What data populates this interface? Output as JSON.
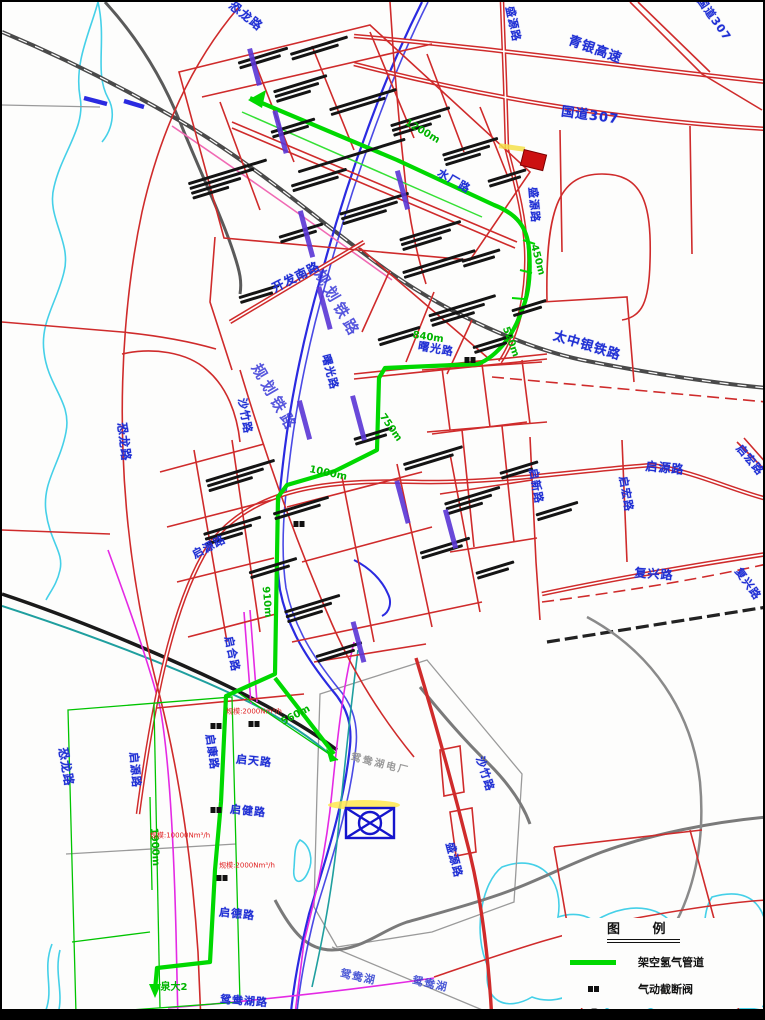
{
  "map": {
    "labels": [
      {
        "text": "恐龙路",
        "x": 244,
        "y": 14,
        "rot": 38,
        "kind": "road",
        "size": 12
      },
      {
        "text": "国道307",
        "x": 712,
        "y": 17,
        "rot": 55,
        "kind": "road",
        "size": 11
      },
      {
        "text": "青银高速",
        "x": 593,
        "y": 48,
        "rot": 20,
        "kind": "road",
        "size": 13
      },
      {
        "text": "国道307",
        "x": 588,
        "y": 114,
        "rot": 8,
        "kind": "road",
        "size": 13
      },
      {
        "text": "盛源路",
        "x": 511,
        "y": 22,
        "rot": 78,
        "kind": "road",
        "size": 11
      },
      {
        "text": "盛源路",
        "x": 532,
        "y": 203,
        "rot": 85,
        "kind": "road",
        "size": 11
      },
      {
        "text": "水厂路",
        "x": 452,
        "y": 179,
        "rot": 30,
        "kind": "road",
        "size": 11
      },
      {
        "text": "太中银铁路",
        "x": 585,
        "y": 344,
        "rot": 17,
        "kind": "road",
        "size": 13
      },
      {
        "text": "恐龙路",
        "x": 122,
        "y": 440,
        "rot": 83,
        "kind": "road",
        "size": 12
      },
      {
        "text": "恐龙路",
        "x": 64,
        "y": 765,
        "rot": 80,
        "kind": "road",
        "size": 12
      },
      {
        "text": "开发南路",
        "x": 294,
        "y": 275,
        "rot": -27,
        "kind": "road",
        "size": 12
      },
      {
        "text": "曙光路",
        "x": 434,
        "y": 347,
        "rot": 10,
        "kind": "road",
        "size": 11
      },
      {
        "text": "曙光路",
        "x": 328,
        "y": 370,
        "rot": 75,
        "kind": "road",
        "size": 11
      },
      {
        "text": "规划铁路",
        "x": 335,
        "y": 302,
        "rot": 60,
        "kind": "road-lg",
        "size": 15
      },
      {
        "text": "规划铁路",
        "x": 272,
        "y": 396,
        "rot": 60,
        "kind": "road-lg",
        "size": 15
      },
      {
        "text": "沙竹路",
        "x": 243,
        "y": 414,
        "rot": 80,
        "kind": "road",
        "size": 11
      },
      {
        "text": "启源路",
        "x": 207,
        "y": 545,
        "rot": -28,
        "kind": "road",
        "size": 11
      },
      {
        "text": "启源路",
        "x": 663,
        "y": 466,
        "rot": 6,
        "kind": "road",
        "size": 12
      },
      {
        "text": "启源路",
        "x": 133,
        "y": 768,
        "rot": 85,
        "kind": "road",
        "size": 11
      },
      {
        "text": "启新路",
        "x": 534,
        "y": 484,
        "rot": 80,
        "kind": "road",
        "size": 11
      },
      {
        "text": "启宏路",
        "x": 624,
        "y": 492,
        "rot": 80,
        "kind": "road",
        "size": 11
      },
      {
        "text": "启宏路",
        "x": 748,
        "y": 458,
        "rot": 50,
        "kind": "road",
        "size": 11
      },
      {
        "text": "复兴路",
        "x": 652,
        "y": 572,
        "rot": 4,
        "kind": "road",
        "size": 12
      },
      {
        "text": "复兴路",
        "x": 746,
        "y": 582,
        "rot": 55,
        "kind": "road",
        "size": 11
      },
      {
        "text": "启合路",
        "x": 230,
        "y": 652,
        "rot": 78,
        "kind": "road",
        "size": 11
      },
      {
        "text": "启康路",
        "x": 210,
        "y": 750,
        "rot": 82,
        "kind": "road",
        "size": 11
      },
      {
        "text": "启天路",
        "x": 252,
        "y": 759,
        "rot": 6,
        "kind": "road",
        "size": 11
      },
      {
        "text": "启健路",
        "x": 246,
        "y": 809,
        "rot": 6,
        "kind": "road",
        "size": 11
      },
      {
        "text": "沙竹路",
        "x": 483,
        "y": 772,
        "rot": 72,
        "kind": "road",
        "size": 11
      },
      {
        "text": "盛源路",
        "x": 452,
        "y": 858,
        "rot": 75,
        "kind": "road",
        "size": 11
      },
      {
        "text": "启德路",
        "x": 235,
        "y": 912,
        "rot": 6,
        "kind": "road",
        "size": 11
      },
      {
        "text": "鸳鸯湖路",
        "x": 242,
        "y": 999,
        "rot": 4,
        "kind": "road",
        "size": 11
      },
      {
        "text": "鸳鸯湖",
        "x": 356,
        "y": 975,
        "rot": 12,
        "kind": "lake",
        "size": 11
      },
      {
        "text": "鸳鸯湖",
        "x": 428,
        "y": 982,
        "rot": 12,
        "kind": "lake",
        "size": 11
      },
      {
        "text": "鸳鸯湖电厂",
        "x": 378,
        "y": 763,
        "rot": 14,
        "kind": "plant",
        "size": 10
      },
      {
        "text": "1200m",
        "x": 420,
        "y": 130,
        "rot": 30,
        "kind": "dist",
        "size": 10
      },
      {
        "text": "450m",
        "x": 535,
        "y": 258,
        "rot": 75,
        "kind": "dist",
        "size": 10
      },
      {
        "text": "520m",
        "x": 508,
        "y": 340,
        "rot": 70,
        "kind": "dist",
        "size": 10
      },
      {
        "text": "840m",
        "x": 426,
        "y": 336,
        "rot": 8,
        "kind": "dist",
        "size": 10
      },
      {
        "text": "750m",
        "x": 388,
        "y": 426,
        "rot": 55,
        "kind": "dist",
        "size": 10
      },
      {
        "text": "1000m",
        "x": 326,
        "y": 472,
        "rot": 12,
        "kind": "dist",
        "size": 10
      },
      {
        "text": "910m",
        "x": 264,
        "y": 600,
        "rot": 85,
        "kind": "dist",
        "size": 10
      },
      {
        "text": "560m",
        "x": 294,
        "y": 714,
        "rot": -28,
        "kind": "dist",
        "size": 10
      },
      {
        "text": "1900m",
        "x": 152,
        "y": 845,
        "rot": 87,
        "kind": "dist",
        "size": 10
      },
      {
        "text": "泉大2",
        "x": 172,
        "y": 986,
        "rot": 0,
        "kind": "dist",
        "size": 10
      },
      {
        "text": "规模:2000Nm³/h",
        "x": 252,
        "y": 710,
        "rot": 0,
        "kind": "note",
        "size": 7
      },
      {
        "text": "规模:10000Nm³/h",
        "x": 178,
        "y": 834,
        "rot": 0,
        "kind": "note",
        "size": 7
      },
      {
        "text": "规模:2000Nm³/h",
        "x": 245,
        "y": 864,
        "rot": 0,
        "kind": "note",
        "size": 7
      }
    ],
    "valves": [
      {
        "x": 468,
        "y": 358
      },
      {
        "x": 297,
        "y": 522
      },
      {
        "x": 214,
        "y": 724
      },
      {
        "x": 214,
        "y": 808
      },
      {
        "x": 220,
        "y": 876
      },
      {
        "x": 252,
        "y": 722
      }
    ],
    "legend": {
      "title": "图 例",
      "items": [
        {
          "symbol": "pipeline-line",
          "label": "架空氢气管道"
        },
        {
          "symbol": "valve",
          "label": "气动截断阀"
        }
      ]
    },
    "colors": {
      "pipeline": "#00d800",
      "road": "#cf2b2b",
      "road_label": "#1f2fd4",
      "railway": "#4a4a4a",
      "river": "#45d0e8",
      "corridor": "#2a2ae0",
      "accent_magenta": "#e42ae4"
    }
  }
}
